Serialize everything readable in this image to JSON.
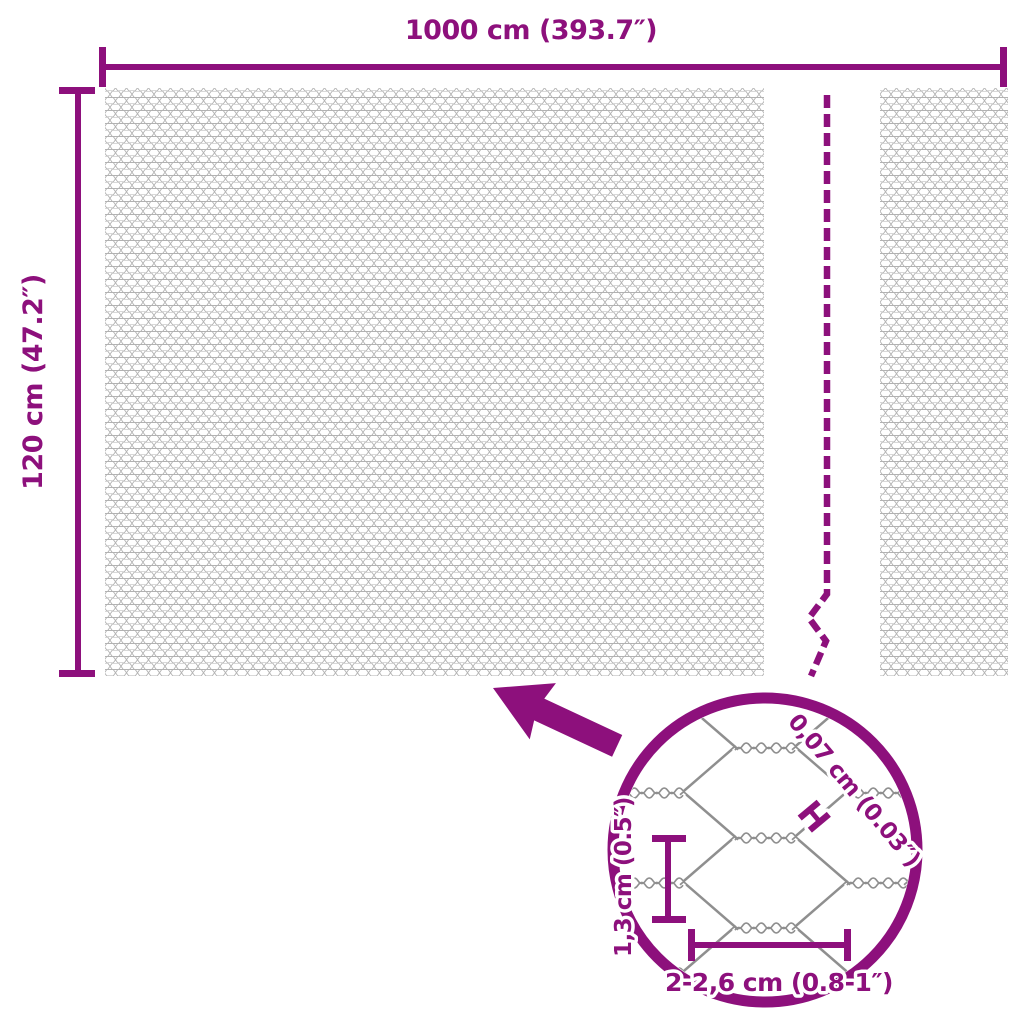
{
  "diagram": {
    "title": "wire-mesh-fence-dimension-diagram",
    "overall": {
      "width_label": "1000 cm (393.7″)",
      "height_label": "120 cm (47.2″)"
    },
    "detail_view": {
      "wire_thickness_label": "0,07 cm (0.03″)",
      "wire_thickness_marker_glyph": "H",
      "mesh_height_label": "1,3 cm (0.5″)",
      "mesh_width_label": "2-2,6 cm (0.8-1″)"
    },
    "colors": {
      "accent": "#8D107C",
      "wire_gray": "#8f8f8f",
      "fine_mesh_gray": "#b2b2b2",
      "background": "#ffffff"
    }
  }
}
